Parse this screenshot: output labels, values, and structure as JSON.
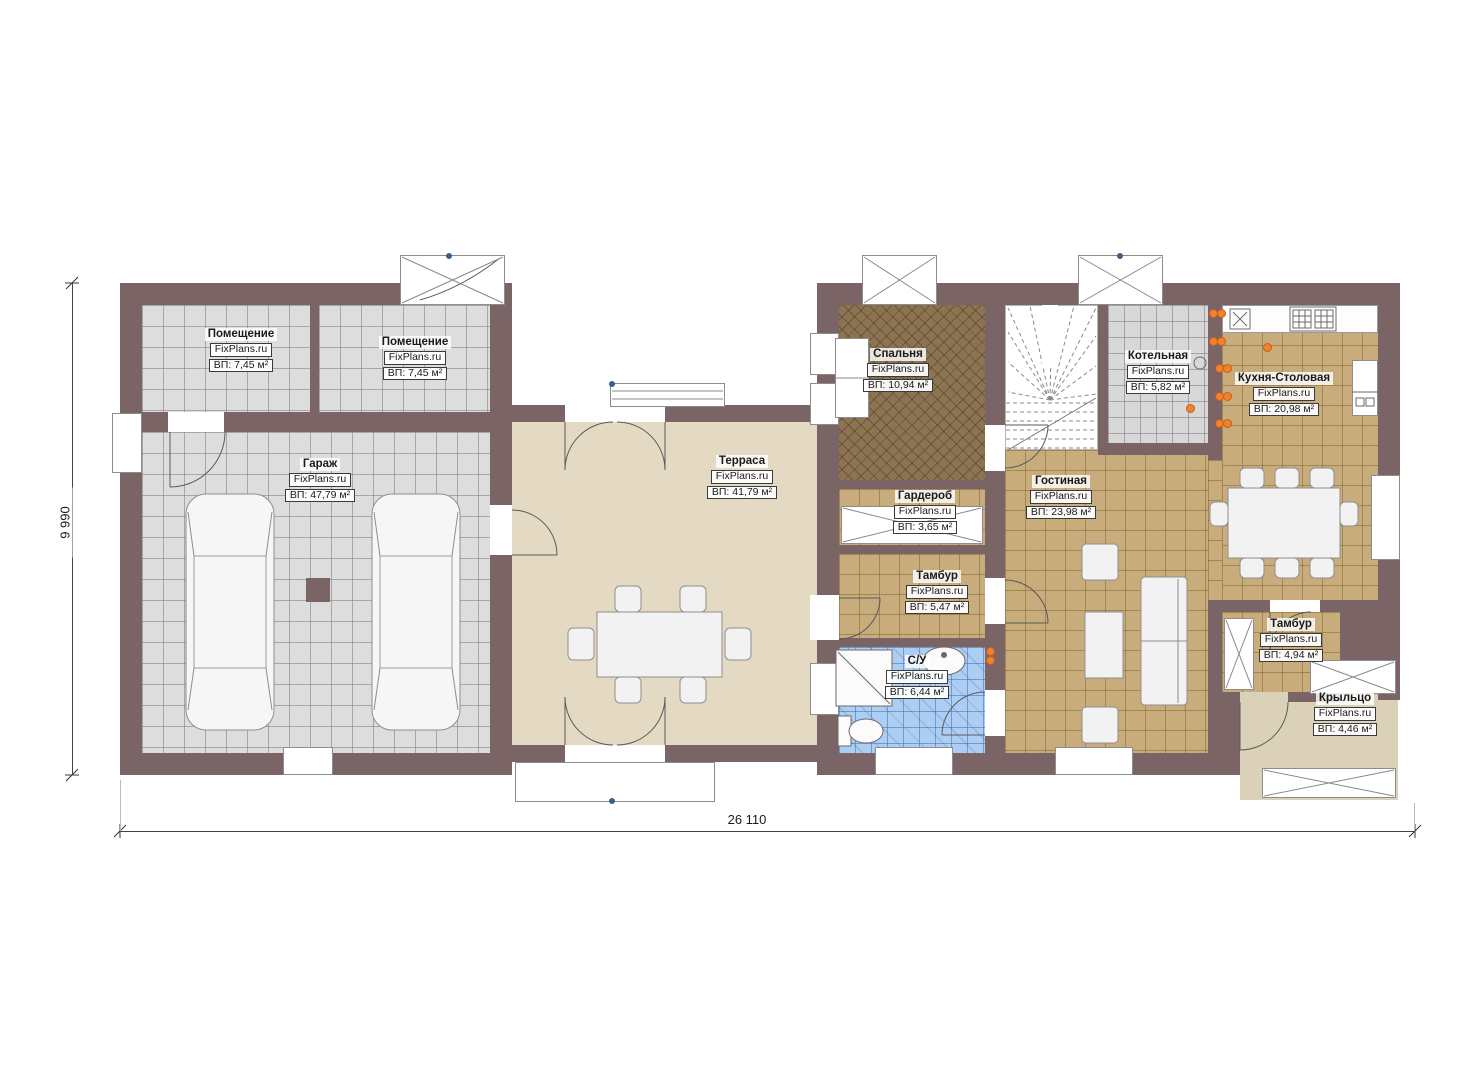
{
  "brand": "FixPlans.ru",
  "dimensions": {
    "bottom": "26 110",
    "left": "9 990"
  },
  "rooms": {
    "pom1": {
      "name": "Помещение",
      "brand": "FixPlans.ru",
      "area": "ВП: 7,45 м²"
    },
    "pom2": {
      "name": "Помещение",
      "brand": "FixPlans.ru",
      "area": "ВП: 7,45 м²"
    },
    "garage": {
      "name": "Гараж",
      "brand": "FixPlans.ru",
      "area": "ВП: 47,79 м²"
    },
    "terrace": {
      "name": "Терраса",
      "brand": "FixPlans.ru",
      "area": "ВП: 41,79 м²"
    },
    "bedroom": {
      "name": "Спальня",
      "brand": "FixPlans.ru",
      "area": "ВП: 10,94 м²"
    },
    "boiler": {
      "name": "Котельная",
      "brand": "FixPlans.ru",
      "area": "ВП: 5,82 м²"
    },
    "kitchen": {
      "name": "Кухня-Столовая",
      "brand": "FixPlans.ru",
      "area": "ВП: 20,98 м²"
    },
    "wardrobe": {
      "name": "Гардероб",
      "brand": "FixPlans.ru",
      "area": "ВП: 3,65 м²"
    },
    "living": {
      "name": "Гостиная",
      "brand": "FixPlans.ru",
      "area": "ВП: 23,98 м²"
    },
    "tambour1": {
      "name": "Тамбур",
      "brand": "FixPlans.ru",
      "area": "ВП: 5,47 м²"
    },
    "bathroom": {
      "name": "С/У",
      "brand": "FixPlans.ru",
      "area": "ВП: 6,44 м²"
    },
    "tambour2": {
      "name": "Тамбур",
      "brand": "FixPlans.ru",
      "area": "ВП: 4,94 м²"
    },
    "porch": {
      "name": "Крыльцо",
      "brand": "FixPlans.ru",
      "area": "ВП: 4,46 м²"
    }
  },
  "colors": {
    "wall": "#7b6465",
    "tile_gray": "#dddddd",
    "tile_tan": "#c9ac7c",
    "tile_blue": "#accef2",
    "bedroom_floor": "#8c7452",
    "terrace_floor": "#e4d9c2",
    "porch_floor": "#dbd0b8",
    "radiator": "#f0812f"
  }
}
